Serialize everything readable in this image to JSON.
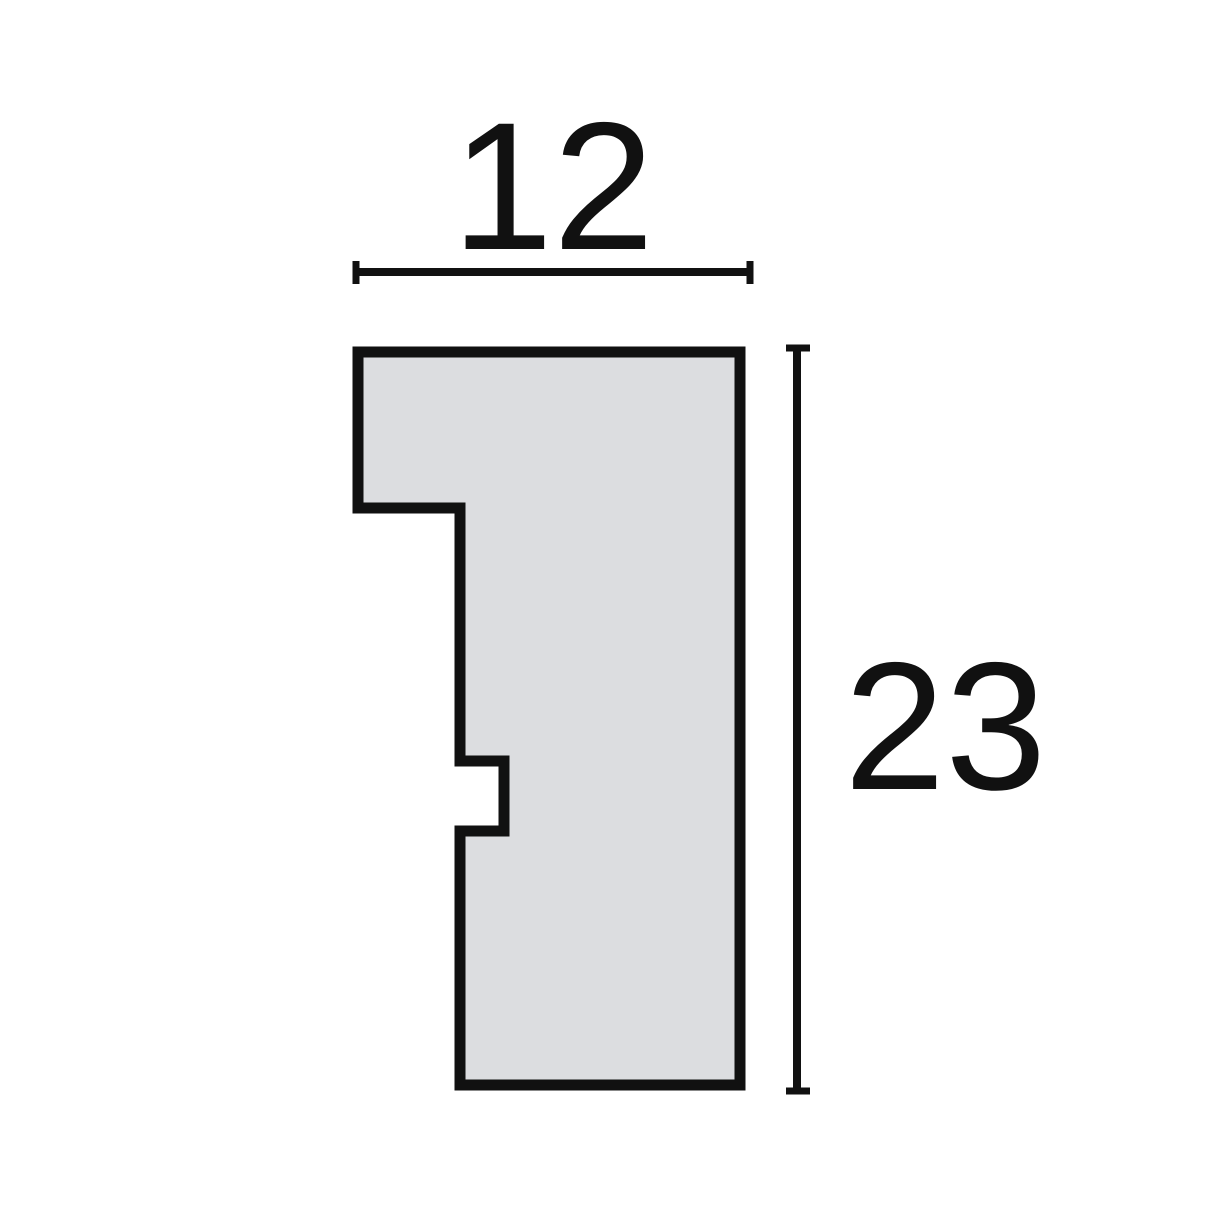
{
  "diagram": {
    "kind": "moulding-profile-cross-section",
    "dimensions": {
      "width": {
        "label": "12",
        "value": 12
      },
      "height": {
        "label": "23",
        "value": 23
      }
    },
    "colors": {
      "background": "#ffffff",
      "shape_fill": "#dcdde0",
      "line": "#111111"
    }
  }
}
